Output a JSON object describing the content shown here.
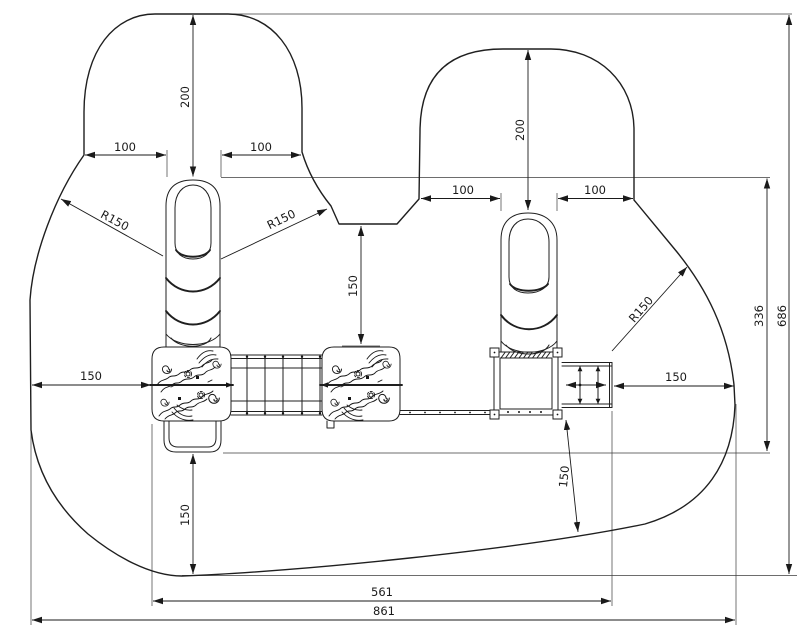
{
  "colors": {
    "line": "#1f1f1f",
    "background": "#ffffff"
  },
  "dimensions": {
    "left_zone_top": "200",
    "right_zone_top": "200",
    "left_zone_side_left": "100",
    "left_zone_side_right": "100",
    "right_zone_side_left": "100",
    "right_zone_side_right": "100",
    "corner_radius_left": "R150",
    "corner_radius_middle": "R150",
    "corner_radius_right": "R150",
    "clearance_left": "150",
    "clearance_center": "150",
    "clearance_right": "150",
    "clearance_bottom": "150",
    "clearance_slide": "150",
    "height_partial": "336",
    "height_overall": "686",
    "width_structure": "561",
    "width_overall": "861"
  }
}
